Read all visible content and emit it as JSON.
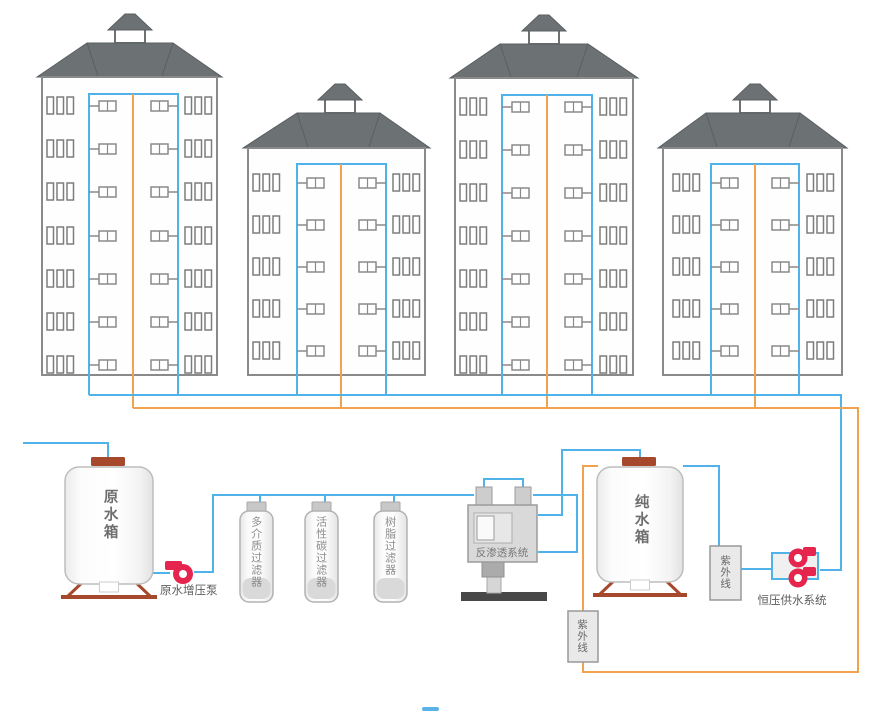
{
  "diagram": {
    "labels": {
      "raw_tank": "原水箱",
      "booster_pump": "原水增压泵",
      "filter_1": "多介质过滤器",
      "filter_2": "活性碳过滤器",
      "filter_3": "树脂过滤器",
      "ro_system": "反渗透系统",
      "pure_tank": "纯水箱",
      "uv_right": "紫外线",
      "uv_bottom": "紫外线",
      "pressure_system": "恒压供水系统"
    },
    "colors": {
      "supply_pipe": "#4FB3EA",
      "return_pipe": "#F0A24E",
      "roof": "#6C7174",
      "roof_edge": "#5A5F62",
      "building_border": "#8A8A8A",
      "window_border": "#7D7D7D",
      "tank_trim": "#A5482B",
      "pump_red": "#E5254E",
      "progress_mark": "#5AB2E8"
    },
    "buildings": [
      {
        "name": "building-1",
        "floors": 7
      },
      {
        "name": "building-2",
        "floors": 5
      },
      {
        "name": "building-3",
        "floors": 7
      },
      {
        "name": "building-4",
        "floors": 5
      }
    ]
  }
}
